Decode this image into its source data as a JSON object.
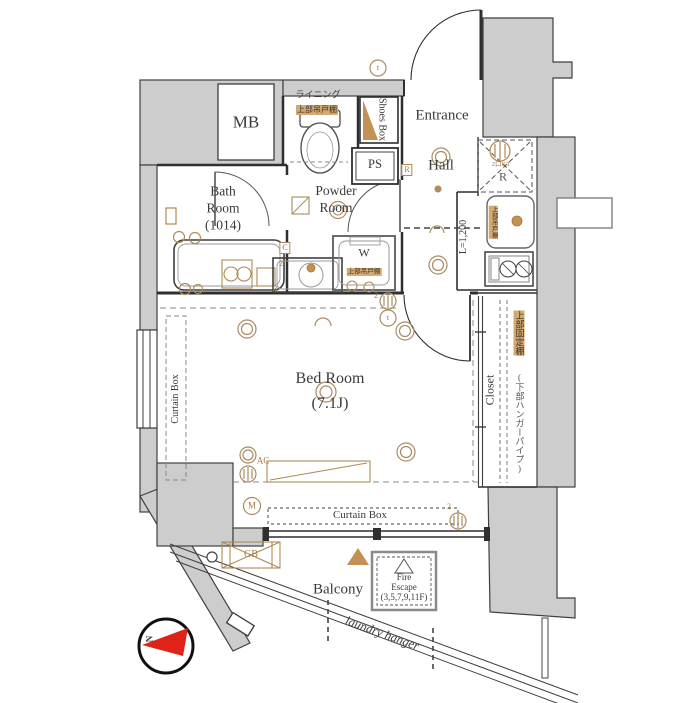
{
  "colors": {
    "wall_gray": "#cdcdcd",
    "accent_tan": "#b08a58",
    "compass_red": "#e02318",
    "line_dark": "#2f2f2f"
  },
  "rooms": {
    "mb": "MB",
    "entrance": "Entrance",
    "hall": "Hall",
    "bath": "Bath\nRoom\n(1014)",
    "powder": "Powder\nRoom",
    "bedroom": "Bed Room\n(7.1J)",
    "closet": "Closet",
    "balcony": "Balcony"
  },
  "storage": {
    "shoes_box": "Shoes Box",
    "ps": "PS"
  },
  "labels": {
    "lining": "ライニング",
    "shelf_toilet": "上部吊戸棚",
    "shelf_washer": "上部吊戸棚",
    "shelf_kitchen": "上部吊戸棚",
    "washer": "W",
    "fridge": "R",
    "hall_r": "R",
    "bath_r": "R",
    "c_box": "C",
    "kitchen_length": "L=1,200",
    "kitchen_note": "2口KT",
    "closet_shelf": "上部固定棚",
    "closet_pipe": "(下部ハンガーパイプ)",
    "curtain_box_left": "Curtain Box",
    "curtain_box_bottom": "Curtain Box",
    "ac": "AC",
    "m": "M",
    "gb": "GB",
    "t_top": "t",
    "t_bed": "t",
    "num2_top": "2",
    "num2_sink": "2",
    "num2_bottom": "2",
    "fire_escape": "Fire\nEscape\n(3,5,7,9,11F)",
    "laundry_hanger": "laundry hanger",
    "north": "N"
  }
}
